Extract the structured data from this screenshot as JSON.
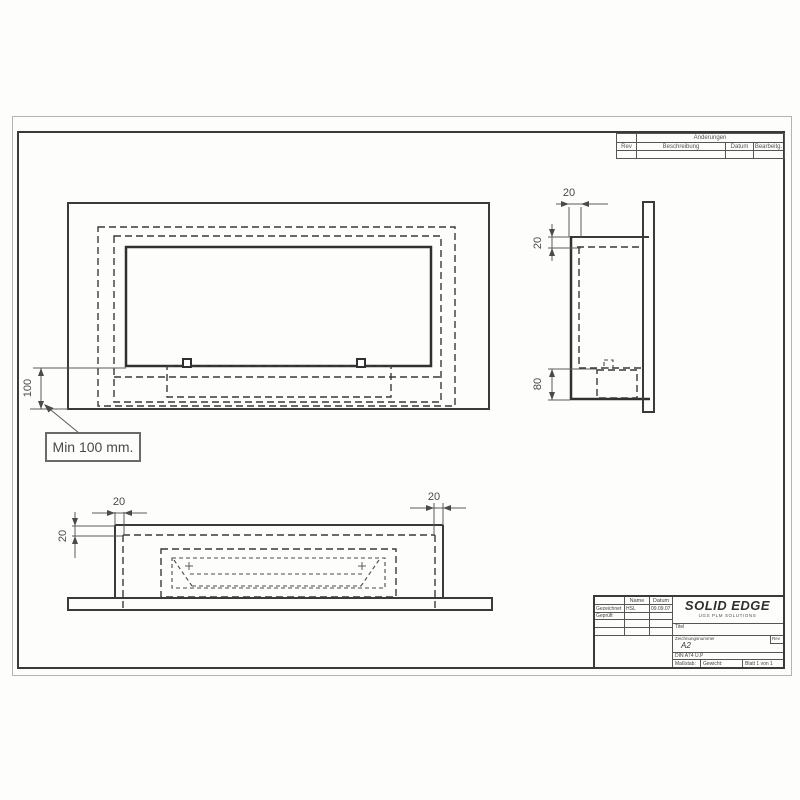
{
  "dims": {
    "front_min_height": "100",
    "min_note": "Min 100 mm.",
    "side_depth": "20",
    "side_wall": "20",
    "side_burner_height": "80",
    "bottom_wall_left": "20",
    "bottom_wall_right": "20",
    "bottom_wall_top": "20"
  },
  "revisions": {
    "header": "Änderungen",
    "col_rev": "Rev",
    "col_desc": "Beschreibung",
    "col_date": "Datum",
    "col_editor": "Bearbeitg."
  },
  "titleblock": {
    "logo": "SOLID EDGE",
    "logo_sub": "UGS PLM SOLUTIONS",
    "name_header": "Name",
    "date_header": "Datum",
    "row1_label": "Gezeichnet",
    "row1_name": "HSL",
    "row1_date": "09.09.07",
    "row2_label": "Geprüft",
    "title_label": "Titel",
    "number_label": "Zeichnungsnummer",
    "number_value": "A2",
    "rev_label": "Rev",
    "file_text": "DIN A74 U.P",
    "scale_label": "Maßstab:",
    "weight_label": "Gewicht:",
    "sheet_label": "Blatt 1 von 1"
  },
  "icons": {
    "views": [
      "front-view",
      "side-view",
      "bottom-view"
    ]
  }
}
